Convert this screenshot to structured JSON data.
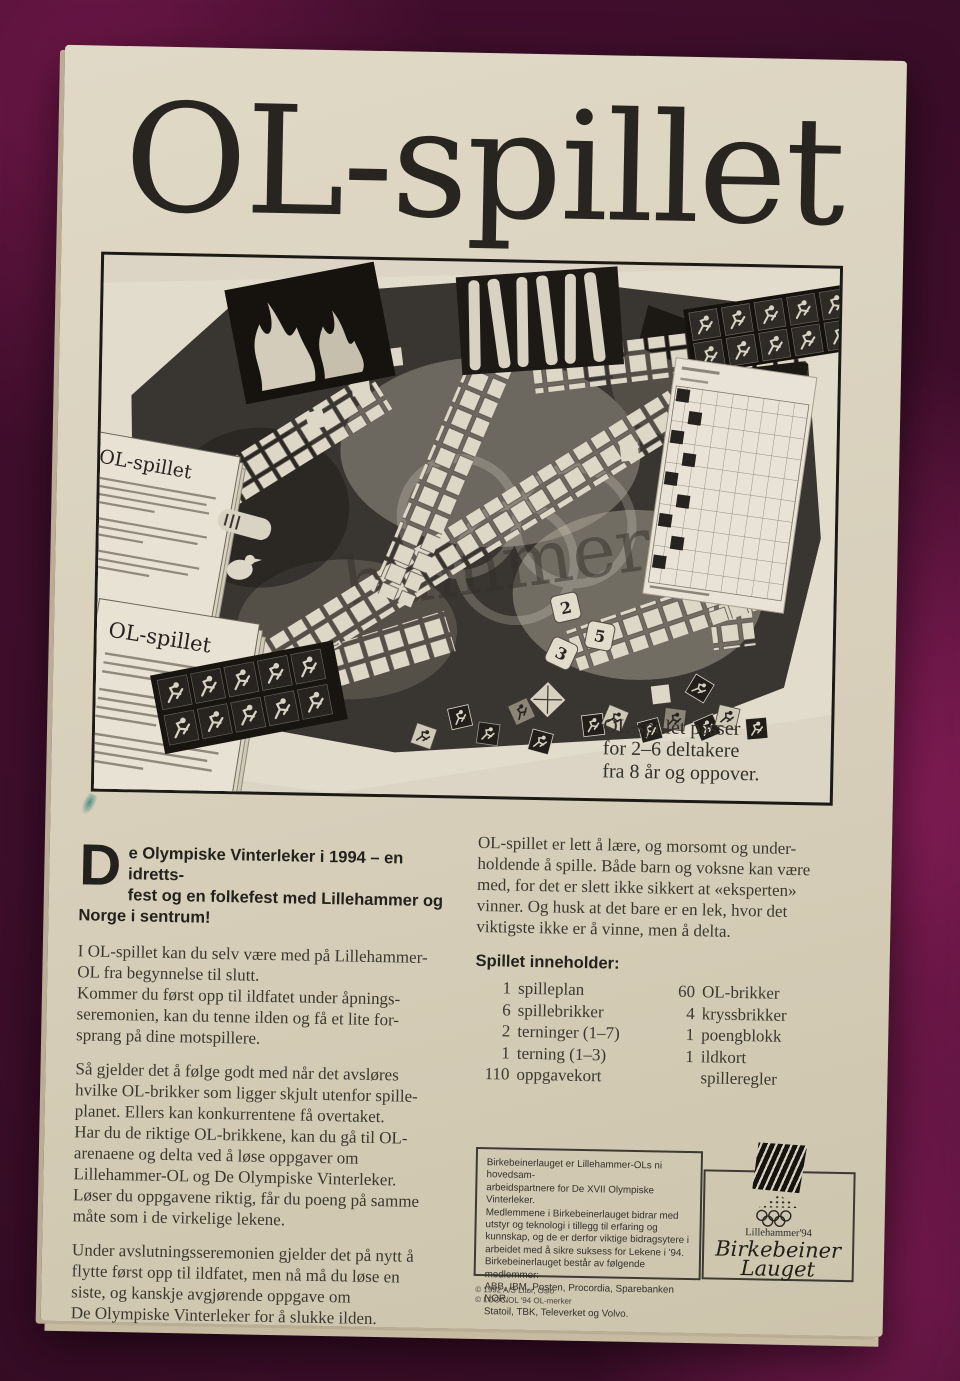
{
  "box": {
    "title": "OL-spillet"
  },
  "photo": {
    "caption": "OL-spillet passer\nfor 2–6 deltakere\nfra 8 år og oppover.",
    "card1_title": "OL-spillet",
    "card2_title": "OL-spillet",
    "watermark": "hammer'94",
    "dice": [
      "2",
      "5",
      "3"
    ]
  },
  "intro": {
    "dropcap": "D",
    "text": "e Olympiske Vinterleker i 1994 – en idretts-\nfest og en folkefest med Lillehammer og\nNorge i sentrum!"
  },
  "left": {
    "p1": "I OL-spillet kan du selv være med på Lillehammer-\nOL fra begynnelse til slutt.\nKommer du først opp til ildfatet under åpnings-\nseremonien, kan du tenne ilden og få et lite for-\nsprang på dine motspillere.",
    "p2": "Så gjelder det å følge godt med når det avsløres\nhvilke OL-brikker som ligger skjult utenfor spille-\nplanet. Ellers kan konkurrentene få overtaket.\nHar du de riktige OL-brikkene, kan du gå til OL-\narenaene og delta ved å løse oppgaver om\nLillehammer-OL og De Olympiske Vinterleker.\nLøser du oppgavene riktig, får du poeng på samme\nmåte som i de virkelige lekene.",
    "p3": "Under avslutningsseremonien gjelder det på nytt å\nflytte først opp til ildfatet, men nå må du løse en\nsiste, og kanskje avgjørende oppgave om\nDe Olympiske Vinterleker for å slukke ilden."
  },
  "right": {
    "p1": "OL-spillet er lett å lære, og morsomt og under-\nholdende å spille. Både barn og voksne kan være\nmed, for det er slett ikke sikkert at «eksperten»\nvinner. Og husk at det bare er en lek, hvor det\nviktigste ikke er å vinne, men å delta."
  },
  "contents": {
    "heading": "Spillet inneholder:",
    "col1": [
      {
        "num": "1",
        "label": "spilleplan"
      },
      {
        "num": "6",
        "label": "spillebrikker"
      },
      {
        "num": "2",
        "label": "terninger (1–7)"
      },
      {
        "num": "1",
        "label": "terning (1–3)"
      },
      {
        "num": "110",
        "label": "oppgavekort"
      }
    ],
    "col2": [
      {
        "num": "60",
        "label": "OL-brikker"
      },
      {
        "num": "4",
        "label": "kryssbrikker"
      },
      {
        "num": "1",
        "label": "poengblokk"
      },
      {
        "num": "1",
        "label": "ildkort"
      },
      {
        "num": "",
        "label": "spilleregler"
      }
    ]
  },
  "sponsor": {
    "text": "Birkebeinerlauget er Lillehammer-OLs ni hovedsam-\narbeidspartnere for De XVII Olympiske Vinterleker.\nMedlemmene i Birkebeinerlauget bidrar med\nutstyr og teknologi i tillegg til erfaring og\nkunnskap, og de er derfor viktige bidragsytere i\narbeidet med å sikre suksess for Lekene i '94.\nBirkebeinerlauget består av følgende medlemmer:\nABB, IBM, Posten, Procordia, Sparebanken NOR,\nStatoil, TBK, Televerket og Volvo.",
    "copyright1": "© 1992 A/S Litor, Oslo",
    "copyright2": "© LOOC/OL '94 OL-merker"
  },
  "logo": {
    "event": "Lillehammer'94",
    "name1": "Birkebeiner",
    "name2": "Lauget"
  },
  "colors": {
    "fabric": "#4c1134",
    "fabric_highlight": "#8e1f5c",
    "box_cream": "#d7cfba",
    "ink": "#282521",
    "photo_dark": "#393530"
  }
}
